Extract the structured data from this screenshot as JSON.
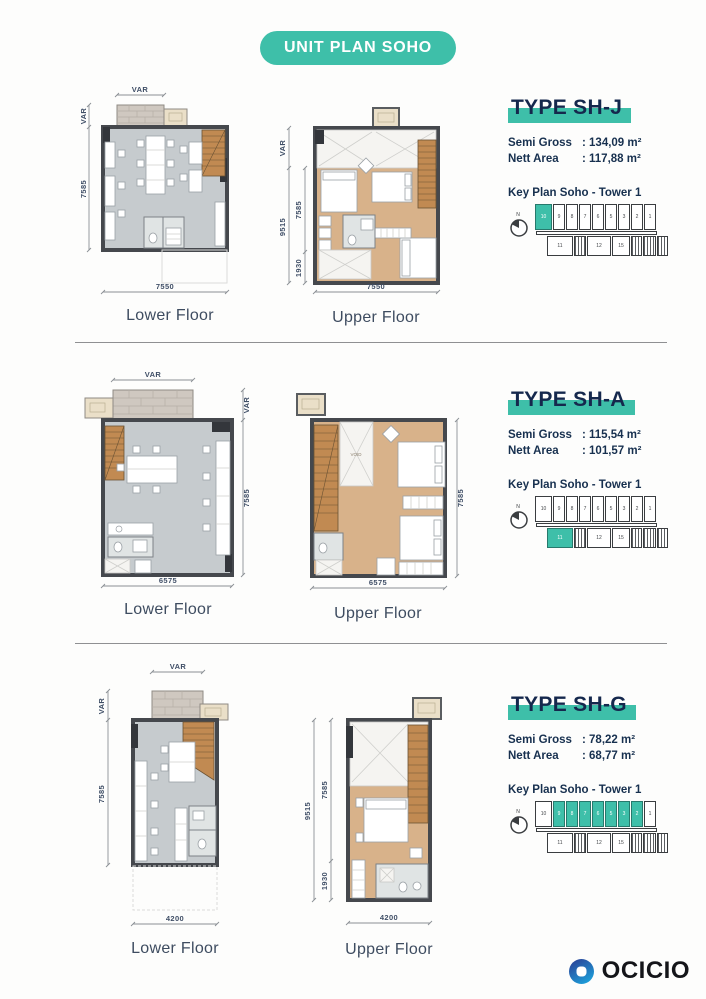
{
  "header": {
    "title": "UNIT PLAN SOHO"
  },
  "brand": {
    "name": "OCICIO"
  },
  "sections": [
    {
      "type_title": "TYPE SH-J",
      "specs": [
        {
          "label": "Semi Gross",
          "value": ": 134,09 m²"
        },
        {
          "label": "Nett Area",
          "value": ": 117,88 m²"
        }
      ],
      "key_plan": {
        "title": "Key Plan Soho - Tower 1",
        "compass_label": "N",
        "top_units": [
          "10",
          "9",
          "8",
          "7",
          "6",
          "5",
          "3",
          "2",
          "1"
        ],
        "bottom_units": [
          "11",
          "12",
          "15"
        ],
        "highlighted": [
          "10"
        ]
      },
      "lower": {
        "label": "Lower Floor",
        "dims": {
          "top": "VAR",
          "side_var": "VAR",
          "side_main": "7585",
          "bottom": "7550"
        }
      },
      "upper": {
        "label": "Upper Floor",
        "dims": {
          "side_outer": "9515",
          "side_var": "VAR",
          "side_main": "7585",
          "side_lower": "1930",
          "bottom": "7550"
        }
      }
    },
    {
      "type_title": "TYPE SH-A",
      "specs": [
        {
          "label": "Semi Gross",
          "value": ": 115,54 m²"
        },
        {
          "label": "Nett Area",
          "value": ": 101,57 m²"
        }
      ],
      "key_plan": {
        "title": "Key Plan Soho - Tower 1",
        "compass_label": "N",
        "top_units": [
          "10",
          "9",
          "8",
          "7",
          "6",
          "5",
          "3",
          "2",
          "1"
        ],
        "bottom_units": [
          "11",
          "12",
          "15"
        ],
        "highlighted": [
          "11"
        ]
      },
      "lower": {
        "label": "Lower Floor",
        "dims": {
          "top": "VAR",
          "side_var": "VAR",
          "side_main": "7585",
          "bottom": "6575"
        }
      },
      "upper": {
        "label": "Upper Floor",
        "room_label": "VOID",
        "dims": {
          "side_main": "7585",
          "bottom": "6575"
        }
      }
    },
    {
      "type_title": "TYPE SH-G",
      "specs": [
        {
          "label": "Semi Gross",
          "value": ": 78,22 m²"
        },
        {
          "label": "Nett Area",
          "value": ": 68,77 m²"
        }
      ],
      "key_plan": {
        "title": "Key Plan Soho - Tower 1",
        "compass_label": "N",
        "top_units": [
          "10",
          "9",
          "8",
          "7",
          "6",
          "5",
          "3",
          "2",
          "1"
        ],
        "bottom_units": [
          "11",
          "12",
          "15"
        ],
        "highlighted": [
          "9",
          "8",
          "7",
          "6",
          "5",
          "3",
          "2"
        ]
      },
      "lower": {
        "label": "Lower Floor",
        "dims": {
          "top": "VAR",
          "side_var": "VAR",
          "side_main": "7585",
          "bottom": "4200"
        }
      },
      "upper": {
        "label": "Upper Floor",
        "dims": {
          "side_outer": "9515",
          "side_main": "7585",
          "side_lower": "1930",
          "bottom": "4200"
        }
      }
    }
  ]
}
